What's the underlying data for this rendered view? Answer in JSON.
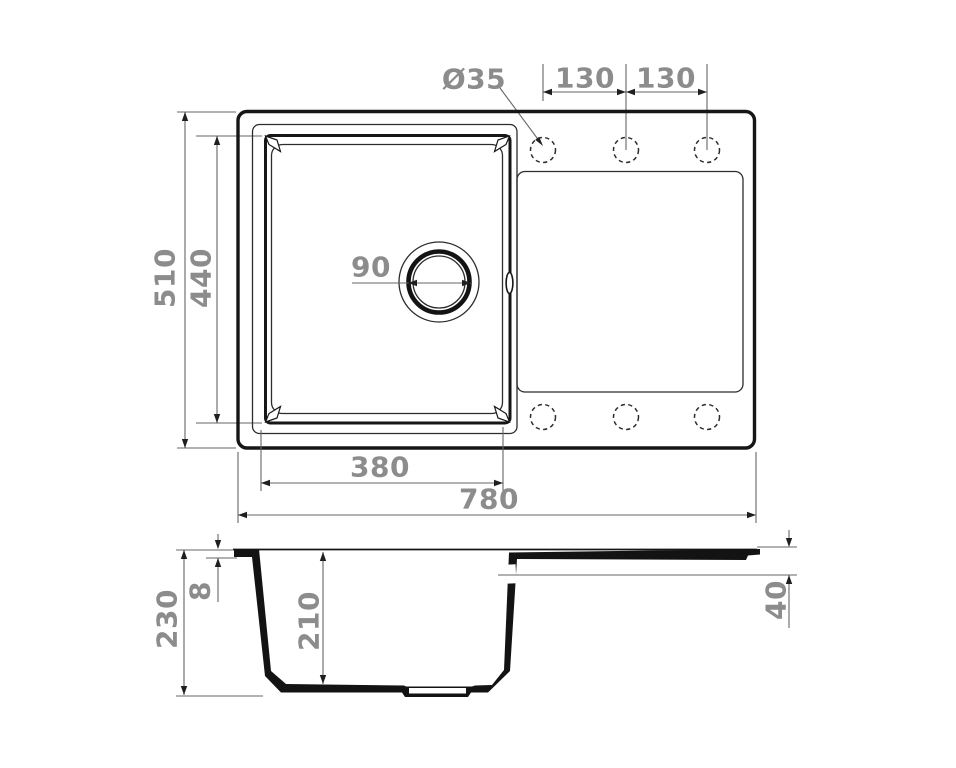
{
  "top_view": {
    "hole_diameter": "Ø35",
    "hole_spacing_left": "130",
    "hole_spacing_right": "130",
    "overall_depth": "510",
    "bowl_depth": "440",
    "drain_diameter": "90",
    "bowl_width": "380",
    "overall_width": "780"
  },
  "side_view": {
    "overall_height": "230",
    "rim_thickness": "8",
    "bowl_depth": "210",
    "drainboard_edge_height": "40"
  },
  "colors": {
    "outline": "#161616",
    "thin_line": "#2c2c2c",
    "dimension_line": "#666666",
    "arrow": "#1f1f1f",
    "label_text": "#8c8c8c",
    "background": "#ffffff"
  }
}
